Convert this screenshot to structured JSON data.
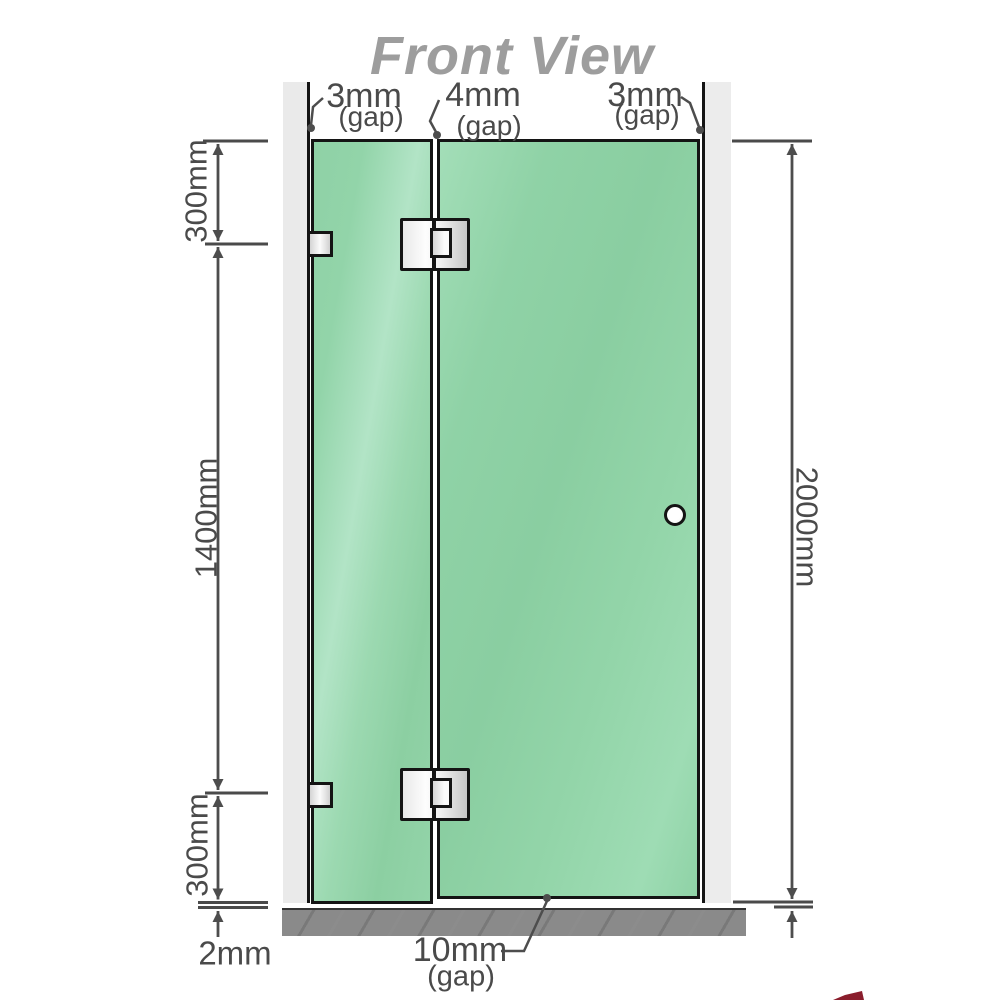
{
  "title": "Front View",
  "diagram": {
    "top_gap_labels": [
      {
        "value": "3mm",
        "qualifier": "(gap)"
      },
      {
        "value": "4mm",
        "qualifier": "(gap)"
      },
      {
        "value": "3mm",
        "qualifier": "(gap)"
      }
    ],
    "left_dimension_labels": [
      {
        "value": "300mm"
      },
      {
        "value": "1400mm"
      },
      {
        "value": "300mm"
      }
    ],
    "right_dimension_label": {
      "value": "2000mm"
    },
    "bottom_labels": {
      "floor_clearance": {
        "value": "2mm"
      },
      "door_gap": {
        "value": "10mm",
        "qualifier": "(gap)"
      }
    }
  },
  "colors": {
    "title_text": "#9d9d9d",
    "dimension_text": "#4a4a4a",
    "dimension_line": "#4d4d4d",
    "glass_green": "#8fd2a7",
    "glass_highlight": "#b2e4c6",
    "wall_gray": "#eaeaea",
    "base_gray": "#8a8a8a",
    "outline_black": "#141414",
    "metal_light": "#fdfdfd",
    "metal_dark": "#c6c6c6",
    "logo_red": "#8a1d2c"
  }
}
